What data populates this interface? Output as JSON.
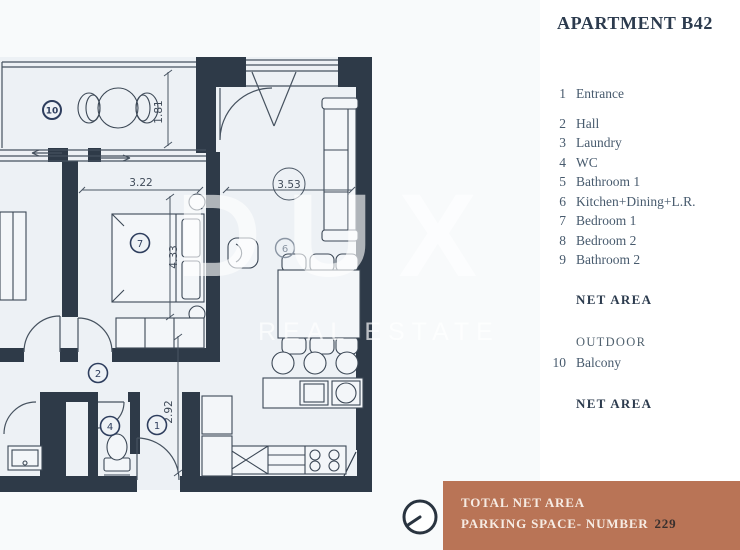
{
  "title": "APARTMENT B42",
  "legend": {
    "items": [
      {
        "num": "1",
        "label": "Entrance"
      },
      {
        "num": "2",
        "label": "Hall"
      },
      {
        "num": "3",
        "label": "Laundry"
      },
      {
        "num": "4",
        "label": "WC"
      },
      {
        "num": "5",
        "label": "Bathroom 1"
      },
      {
        "num": "6",
        "label": "Kitchen+Dining+L.R."
      },
      {
        "num": "7",
        "label": "Bedroom 1"
      },
      {
        "num": "8",
        "label": "Bedroom 2"
      },
      {
        "num": "9",
        "label": "Bathroom 2"
      }
    ],
    "net_area_1": "NET AREA",
    "outdoor_header": "OUTDOOR",
    "outdoor_item": {
      "num": "10",
      "label": "Balcony"
    },
    "net_area_2": "NET AREA"
  },
  "watermark": {
    "line1": "DUX",
    "line2": "REAL ESTATE"
  },
  "floorplan": {
    "markers": {
      "balcony": "10",
      "bedroom1": "7",
      "kitchen": "6",
      "hall": "2",
      "wc": "4",
      "entrance": "1"
    },
    "dimensions": {
      "balcony_height": "1.81",
      "bedroom_width": "3.22",
      "living_width": "3.53",
      "bedroom_height": "4.33",
      "entrance_height": "2.92"
    }
  },
  "footer": {
    "line1": "TOTAL NET AREA",
    "line2_label": "PARKING SPACE- NUMBER",
    "line2_value": "229"
  },
  "colors": {
    "bar": "#b97456",
    "wall": "#2e3a48",
    "marker": "#2e3e5e",
    "plan_bg": "#edf1f5",
    "page_bg": "#ffffff"
  }
}
